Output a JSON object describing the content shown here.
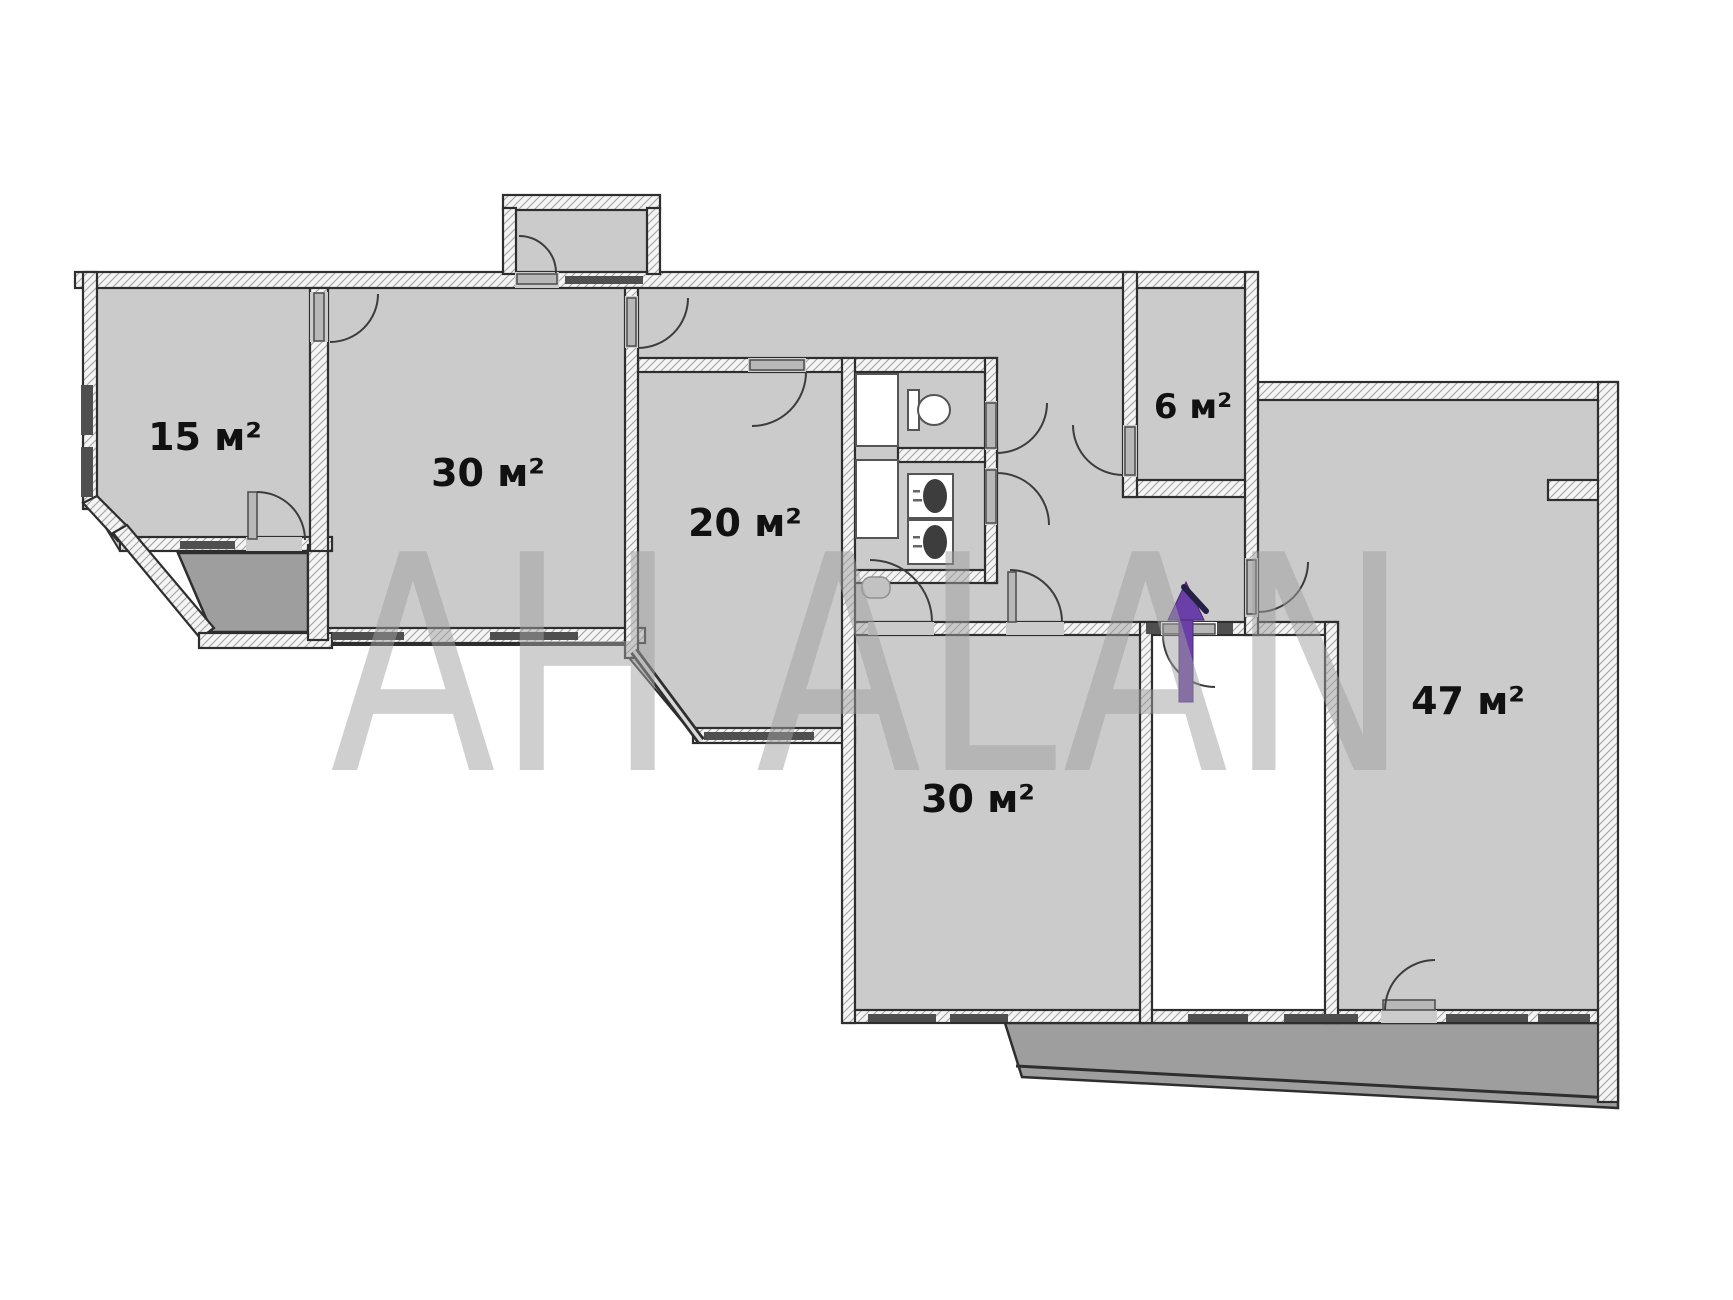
{
  "watermark": {
    "text": "АН ALAN"
  },
  "rooms": [
    {
      "id": "room-15",
      "label": "15 м²"
    },
    {
      "id": "room-30-top",
      "label": "30 м²"
    },
    {
      "id": "room-20",
      "label": "20 м²"
    },
    {
      "id": "room-6",
      "label": "6 м²"
    },
    {
      "id": "room-47",
      "label": "47 м²"
    },
    {
      "id": "room-30-bottom",
      "label": "30 м²"
    }
  ],
  "colors": {
    "room_fill": "#cbcbcb",
    "balcony_fill": "#9e9e9e",
    "wall_fill": "#f4f4f4",
    "hatch": "#a3a3a3",
    "outline": "#2e2e2e",
    "window_bar": "#4f4f4f",
    "door_leaf": "#b8b8b8",
    "watermark": "#a0a0a0",
    "arrow": "#6b3fa8"
  }
}
